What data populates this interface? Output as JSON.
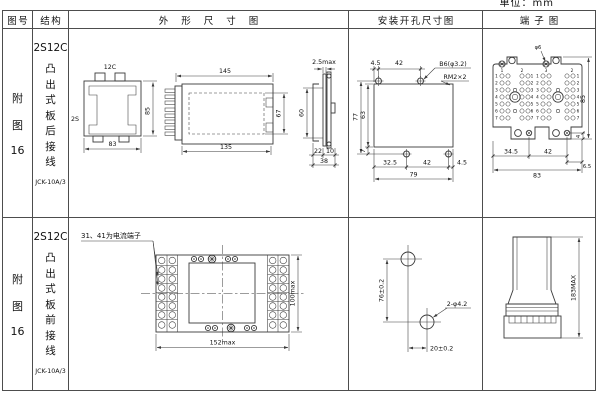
{
  "page": {
    "unit": "单位：mm"
  },
  "header": {
    "fig": "图号",
    "structure": "结构",
    "outline": "外形尺寸图",
    "mounting": "安装开孔尺寸图",
    "terminal": "端子图"
  },
  "rows": [
    {
      "fig": {
        "c1": "附",
        "c2": "图",
        "num": "16"
      },
      "structure": {
        "model": "2S12C",
        "chars": [
          "凸",
          "出",
          "式",
          "板",
          "后",
          "接",
          "线"
        ],
        "code": "JCK-10A/3"
      },
      "outline": {
        "top_label": "12C",
        "side_label": "2S",
        "height": "85",
        "width": "83",
        "len_top": "145",
        "len_bottom": "135",
        "inner_h": "67",
        "panel": "2.5max",
        "cutout_h": "60",
        "d22": "22",
        "d10": "10",
        "d38": "38"
      },
      "mounting": {
        "top_off": "4.5",
        "top_pitch": "42",
        "hole_label": "B6(φ3.2)",
        "screw_label": "RM2×2",
        "outer_h": "77",
        "inner_h": "63",
        "bot_off": "7",
        "bot_a": "32.5",
        "bot_b": "42",
        "bot_c": "4.5",
        "total_w": "79"
      },
      "terminal": {
        "hole_label": "φ6",
        "col_nums": [
          "1",
          "2",
          "3",
          "2"
        ],
        "row_nums": [
          "1",
          "2",
          "3",
          "4",
          "5",
          "6",
          "7"
        ],
        "bot_a": "34.5",
        "bot_b": "42",
        "bot_c": "6.5",
        "total_w": "83",
        "height": "85",
        "foot": "4"
      }
    },
    {
      "fig": {
        "c1": "附",
        "c2": "图",
        "num": "16"
      },
      "structure": {
        "model": "2S12C",
        "chars": [
          "凸",
          "出",
          "式",
          "板",
          "前",
          "接",
          "线"
        ],
        "code": "JCK-10A/3"
      },
      "outline": {
        "note": "31、41为电流端子",
        "width": "152max",
        "height": "100max"
      },
      "mounting": {
        "v_pitch": "76±0.2",
        "h_pitch": "20±0.2",
        "holes_label": "2-φ4.2"
      },
      "terminal": {
        "height": "183MAX"
      }
    }
  ]
}
